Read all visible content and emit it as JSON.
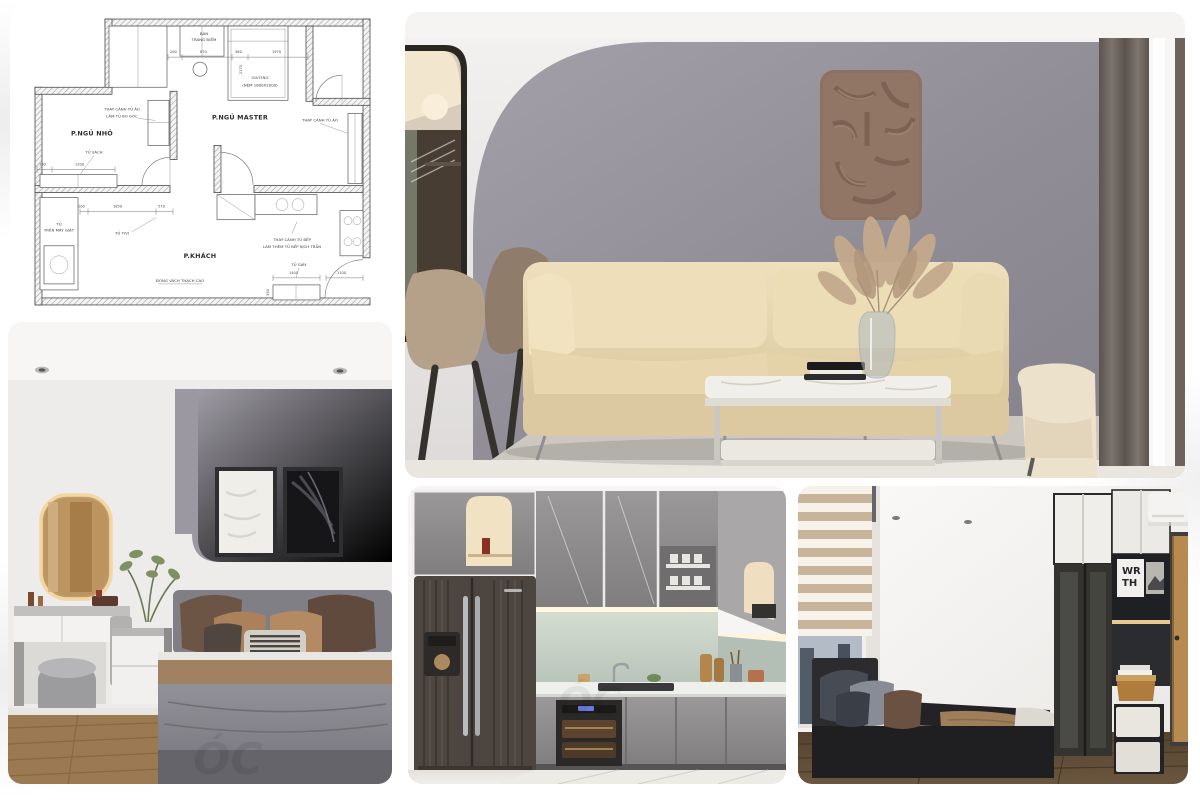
{
  "collage": {
    "tiles": [
      "floor-plan",
      "living-room",
      "master-bedroom",
      "kitchen",
      "small-bedroom"
    ]
  },
  "floor_plan": {
    "rooms": {
      "small_bedroom": "P.NGỦ NHỎ",
      "master_bedroom": "P.NGỦ MASTER",
      "living_room": "P.KHÁCH"
    },
    "annotations": {
      "dressing_l1": "BÀN",
      "dressing_l2": "TRANG ĐIỂM",
      "bed_l1": "GIƯỜNG",
      "bed_l2": "(NỆM 1800X2000)",
      "wardrobe_small_l1": "THAY CÁNH TỦ ÁO",
      "wardrobe_small_l2": "LÀM TỦ BO GÓC",
      "wardrobe_master": "THAY CÁNH TỦ ÁO",
      "bookshelf": "TỦ SÁCH",
      "washer_l1": "TỦ",
      "washer_l2": "TRÊN MÁY GIẶT",
      "tv": "TỦ TIVI",
      "kitchen_l1": "THAY CÁNH TỦ BẾP",
      "kitchen_l2": "LÀM THÊM TỦ BẾP KỊCH TRẦN",
      "gypsum": "ĐÓNG VÁCH THẠCH CAO",
      "shoe": "TỦ GIÀY"
    },
    "dimensions": {
      "d200a": "200",
      "d870": "870",
      "d360": "360",
      "d1970": "1970",
      "d2170": "2170",
      "d190": "190",
      "d1200": "1200",
      "d200b": "200",
      "d1850": "1850",
      "d570": "570",
      "d1400": "1400",
      "d1100": "1100",
      "d350": "350"
    }
  },
  "bedroom_small": {
    "poster_l1": "WR",
    "poster_l2": "TH"
  },
  "watermark": "ÓC",
  "palette": {
    "background": "#ffffff",
    "plan_line": "#4a4a4a",
    "sofa_beige": "#e6d5b0",
    "accent_wall_gray": "#8f8c94",
    "wall_art_brown": "#8d7163",
    "wood_floor": "#9b7a52",
    "kitchen_cabinet_gray": "#8a8889",
    "fridge_dark_wood": "#4c4540",
    "backsplash_green": "#c6d0c5",
    "warm_led": "#f2e2c4",
    "dark_bed": "#242326",
    "zebra_blind_tan": "#c8b49a"
  }
}
